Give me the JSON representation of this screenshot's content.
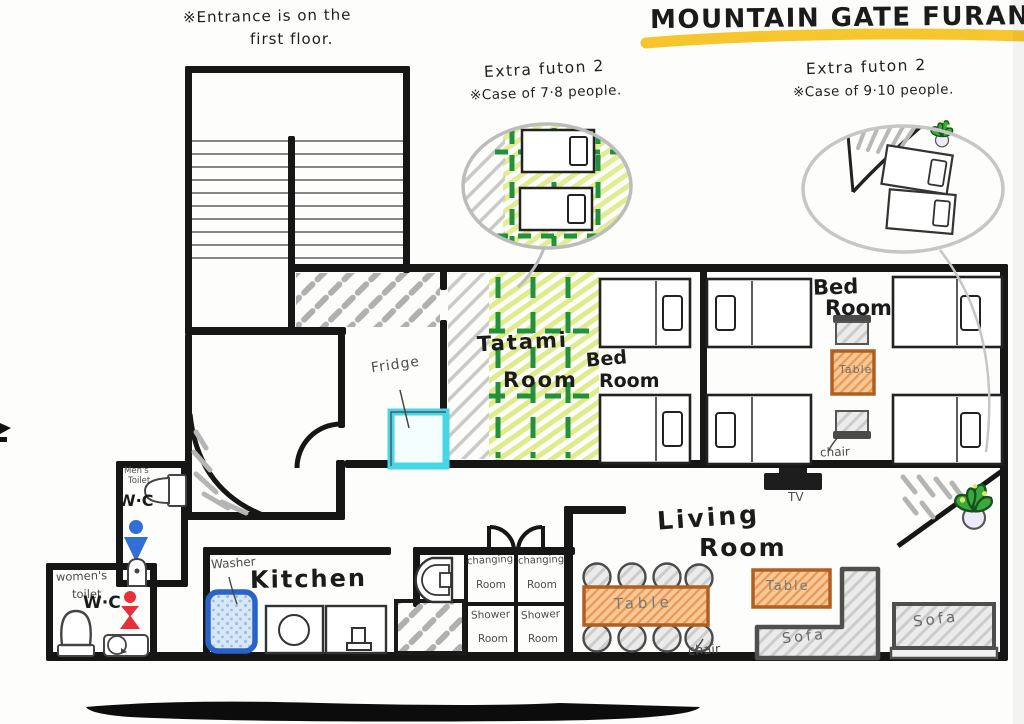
{
  "title": "MOUNTAIN GATE FURANO",
  "note": {
    "line1": "※Entrance is on the",
    "line2": "first floor."
  },
  "callouts": {
    "left": {
      "title": "Extra futon 2",
      "case": "※Case of 7·8 people."
    },
    "right": {
      "title": "Extra futon 2",
      "case": "※Case of 9·10 people."
    }
  },
  "rooms": {
    "tatami": {
      "l1": "Tatami",
      "l2": "Room"
    },
    "bedroom_center": {
      "l1": "Bed",
      "l2": "Room"
    },
    "bedroom_right": {
      "l1": "Bed",
      "l2": "Room"
    },
    "living": {
      "l1": "Living",
      "l2": "Room"
    },
    "kitchen": "Kitchen",
    "changing": {
      "l1": "changing",
      "l2": "Room"
    },
    "shower": {
      "l1": "Shower",
      "l2": "Room"
    },
    "mens_toilet": {
      "l1": "Men's",
      "l2": "Toilet",
      "wc": "W·C"
    },
    "womens_toilet": {
      "l1": "women's",
      "l2": "toilet",
      "wc": "W·C"
    }
  },
  "furniture": {
    "fridge": "Fridge",
    "washer": "Washer",
    "table": "Table",
    "chair": "chair",
    "sofa": "Sofa",
    "tv": "TV"
  },
  "icons": {
    "mens": "male-figure-icon",
    "womens": "female-figure-icon",
    "plant": "potted-plant-icon"
  },
  "colors": {
    "highlight_yellow": "#F5C324",
    "tatami_green": "#23913C",
    "fridge_cyan": "#45D7E8",
    "washer_blue": "#2A63C8",
    "table_orange": "#C8762E",
    "male_blue": "#2F6FD6",
    "female_red": "#E8303A"
  }
}
